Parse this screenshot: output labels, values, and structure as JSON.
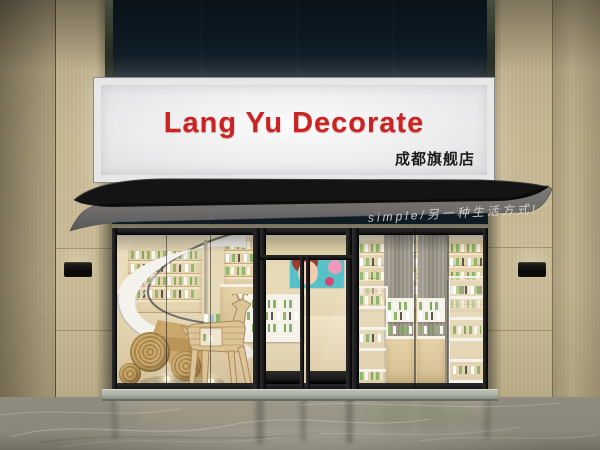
{
  "sign": {
    "brand": "Lang Yu Decorate",
    "subtitle": "成都旗舰店"
  },
  "awning": {
    "slogan": "simple/另一种生活方式!"
  },
  "palette": {
    "tile": "#c6b994",
    "headerDark": "#0e1a24",
    "signPanel": "#ededee",
    "brandRed": "#c92421",
    "ink": "#1e1e1e",
    "awningRoof": "#141414",
    "awningFabric": "#6f6e6c",
    "awningText": "#d8d8d4",
    "frameBlack": "#1a1a1a",
    "interiorWarm": "#e9dcba",
    "shelfWhite": "#f5f2ea",
    "productGreen": "#8eb56c",
    "mirrorGray": "#a39d90",
    "floorGray": "#8b877b",
    "stepStone": "#aab0a6",
    "posterTeal": "#56c2c8",
    "woodDeer": "#dcc497",
    "staircaseWhite": "#f3f2ed"
  }
}
